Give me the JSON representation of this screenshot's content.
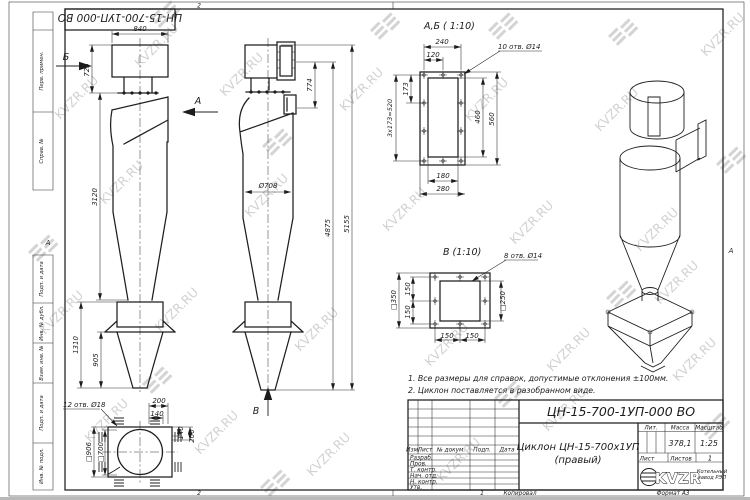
{
  "watermark": {
    "text": "KVZR.RU"
  },
  "frame": {
    "top_stamp": "ЦН-15-700-1УП-000 ВО",
    "zone_top": "2",
    "zone_bottom_l": "2",
    "zone_bottom_r": "1",
    "zone_row_l": "А",
    "zone_row_r": "А",
    "margin_labels": [
      "Перв. примен.",
      "Справ. №",
      "Подп. и дата",
      "Инв. № дубл.",
      "Взам. инв. №",
      "Подп. и дата",
      "Инв. № подл."
    ],
    "copied": "Копировал",
    "format": "Формат А3"
  },
  "notes": [
    "1. Все размеры для справок, допустимые отклонения ±100мм.",
    "2. Циклон поставляется в разобранном виде."
  ],
  "front_view": {
    "arrow_b": "Б",
    "arrow_a": "А",
    "dim_width": "840",
    "dim_top": "725",
    "dim_body": "3120",
    "dim_bunker": "1310",
    "dim_pyramid": "905"
  },
  "bottom_view": {
    "leader": "12 отв. Ø18",
    "dim_200t": "200",
    "dim_140t": "140",
    "dim_140r": "140",
    "dim_200r": "200",
    "dim_sq906": "□906",
    "dim_sq700": "□700"
  },
  "side_view": {
    "arrow_v": "В",
    "dim_774": "774",
    "dim_d708": "Ø708",
    "dim_4875": "4875",
    "dim_5155": "5155"
  },
  "section_ab": {
    "title": "А,Б ( 1:10)",
    "leader": "10 отв. Ø14",
    "d240": "240",
    "d120": "120",
    "d173": "173",
    "d520": "3x173=520",
    "d460": "460",
    "d560": "560",
    "d180": "180",
    "d280": "280"
  },
  "section_v": {
    "title": "В (1:10)",
    "leader": "8 отв. Ø14",
    "sq350": "□350",
    "l150a": "150",
    "l150b": "150",
    "sq250": "□250",
    "b150a": "150",
    "b150b": "150"
  },
  "title_block": {
    "designation": "ЦН-15-700-1УП-000 ВО",
    "name_line1": "Циклон ЦН-15-700х1УП",
    "name_line2": "(правый)",
    "col_izm": "Изм.",
    "col_list": "Лист",
    "col_doc": "№ докум.",
    "col_podp": "Подп.",
    "col_data": "Дата",
    "rows": [
      "Разраб.",
      "Пров.",
      "Т. контр.",
      "Нач. отд.",
      "Н. контр.",
      "Утв."
    ],
    "lit": "Лит.",
    "mass_label": "Масса",
    "scale_label": "Масштаб",
    "mass": "378,1",
    "scale": "1:25",
    "sheet_label": "Лист",
    "sheets_label": "Листов",
    "sheets": "1",
    "logo": "KVZR",
    "tagline1": "Котельный",
    "tagline2": "завод РЭП"
  }
}
